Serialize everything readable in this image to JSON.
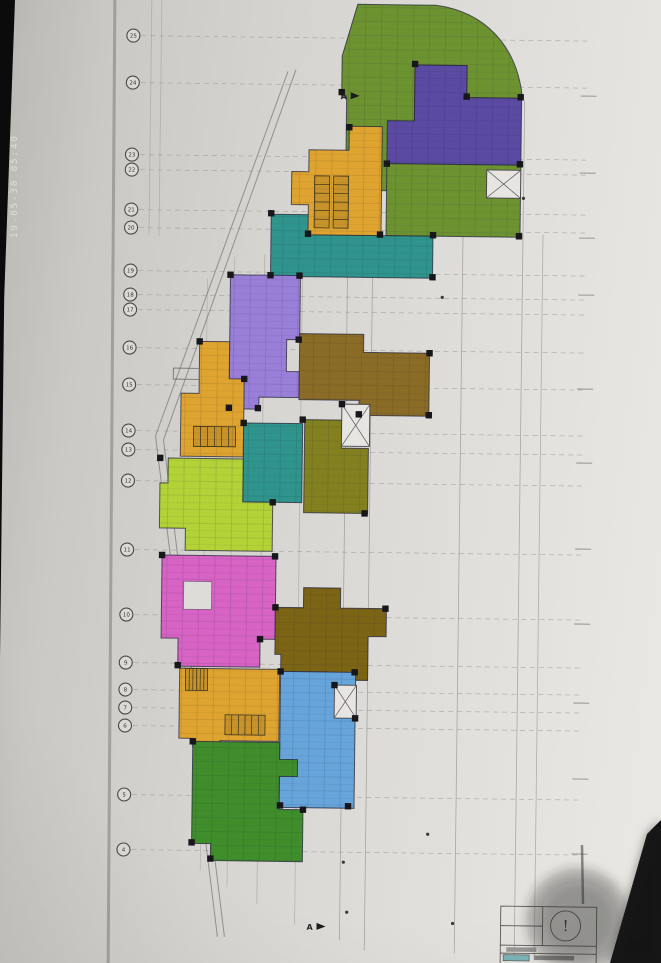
{
  "photo": {
    "timestamp": "19-05-30 05:40",
    "screen_edge_color": "#0b0b0b"
  },
  "plan": {
    "grid": {
      "circle_x": 128,
      "line_x1": 136,
      "line_x2": 584,
      "rows": [
        {
          "y": 38,
          "label": "25"
        },
        {
          "y": 85,
          "label": "24"
        },
        {
          "y": 157,
          "label": "23"
        },
        {
          "y": 172,
          "label": "22"
        },
        {
          "y": 212,
          "label": "21"
        },
        {
          "y": 230,
          "label": "20"
        },
        {
          "y": 273,
          "label": "19"
        },
        {
          "y": 297,
          "label": "18"
        },
        {
          "y": 312,
          "label": "17"
        },
        {
          "y": 350,
          "label": "16"
        },
        {
          "y": 387,
          "label": "15"
        },
        {
          "y": 433,
          "label": "14"
        },
        {
          "y": 452,
          "label": "13"
        },
        {
          "y": 483,
          "label": "12"
        },
        {
          "y": 552,
          "label": "11"
        },
        {
          "y": 617,
          "label": "10"
        },
        {
          "y": 665,
          "label": "9"
        },
        {
          "y": 692,
          "label": "8"
        },
        {
          "y": 710,
          "label": "7"
        },
        {
          "y": 728,
          "label": "6"
        },
        {
          "y": 797,
          "label": "5"
        },
        {
          "y": 852,
          "label": "4"
        }
      ],
      "verticals": [
        {
          "x": 146,
          "y1": 0,
          "y2": 238,
          "o": 0.3
        },
        {
          "x": 156,
          "y1": 0,
          "y2": 238,
          "o": 0.3
        },
        {
          "x": 205,
          "y1": 280,
          "y2": 872,
          "o": 0.3
        },
        {
          "x": 232,
          "y1": 258,
          "y2": 888,
          "o": 0.3
        },
        {
          "x": 262,
          "y1": 255,
          "y2": 905,
          "o": 0.35
        },
        {
          "x": 300,
          "y1": 235,
          "y2": 925,
          "o": 0.35
        },
        {
          "x": 345,
          "y1": 95,
          "y2": 940,
          "o": 0.5
        },
        {
          "x": 370,
          "y1": 60,
          "y2": 950,
          "o": 0.5
        },
        {
          "x": 460,
          "y1": 98,
          "y2": 952,
          "o": 0.5
        },
        {
          "x": 520,
          "y1": 98,
          "y2": 958,
          "o": 0.5
        },
        {
          "x": 540,
          "y1": 232,
          "y2": 958,
          "o": 0.45
        }
      ],
      "diagonals": [
        [
          283,
          72,
          155,
          438
        ],
        [
          291,
          70,
          163,
          442
        ],
        [
          155,
          438,
          223,
          938
        ],
        [
          163,
          442,
          230,
          938
        ]
      ],
      "right_ticks": [
        93,
        170,
        235,
        292,
        386,
        460,
        546,
        621,
        700,
        776,
        851
      ],
      "right_tick_x1": 576,
      "right_tick_x2": 592
    },
    "units": [
      {
        "id": "unit-green-top",
        "color": "#6d9331",
        "path": "M352,4 L430,4 C480,10 510,44 517,90 L517,96 L462,96 L462,64 L410,64 L410,190 L376,190 L376,162 L342,162 L342,96 L337,96 L337,56 Z"
      },
      {
        "id": "unit-purple",
        "color": "#5b4aa2",
        "path": "M410,64 L462,64 L462,96 L517,96 L517,163 L383,163 L383,120 L410,120 Z"
      },
      {
        "id": "unit-green-right",
        "color": "#6d9331",
        "path": "M383,163 L517,163 L517,235 L383,235 Z"
      },
      {
        "id": "unit-teal-top",
        "color": "#2f948c",
        "path": "M268,215 L310,215 L310,235 L430,235 L430,277 L268,277 Z"
      },
      {
        "id": "unit-orange-core-1",
        "color": "#dfa42f",
        "path": "M345,126 L378,126 L378,235 L305,235 L305,205 L288,205 L288,172 L305,172 L305,150 L345,150 Z"
      },
      {
        "id": "unit-violet",
        "color": "#9a7fd8",
        "path": "M228,276 L298,276 L298,340 L285,340 L285,372 L298,372 L298,398 L258,398 L258,410 L228,410 Z"
      },
      {
        "id": "unit-brown-mid",
        "color": "#8a6c26",
        "path": "M298,334 L362,334 L362,352 L428,352 L428,415 L358,415 L358,400 L298,400 Z"
      },
      {
        "id": "unit-orange-core-2",
        "color": "#dfa42f",
        "path": "M198,343 L228,343 L228,380 L243,380 L243,458 L180,458 L180,395 L198,395 Z"
      },
      {
        "id": "unit-olive",
        "color": "#83811f",
        "path": "M304,420 L341,420 L341,448 L368,448 L368,513 L304,513 Z"
      },
      {
        "id": "unit-teal-mid",
        "color": "#2f948c",
        "path": "M243,424 L302,424 L302,503 L243,503 Z"
      },
      {
        "id": "unit-lime",
        "color": "#b2d238",
        "path": "M168,460 L243,460 L243,503 L273,503 L273,552 L186,552 L186,530 L160,530 L160,485 L168,485 Z"
      },
      {
        "id": "unit-magenta",
        "color": "#d763c4",
        "path": "M163,557 L277,557 L277,640 L262,640 L262,668 L180,668 L180,640 L163,640 Z"
      },
      {
        "id": "unit-brown-dark",
        "color": "#7c6415",
        "path": "M277,608 L305,608 L305,588 L342,588 L342,608 L388,608 L388,636 L370,636 L370,680 L330,680 L330,672 L283,672 L283,655 L277,655 Z"
      },
      {
        "id": "unit-orange-core-3",
        "color": "#dfa42f",
        "path": "M182,670 L282,670 L282,742 L223,742 L223,748 L196,748 L196,740 L182,740 Z"
      },
      {
        "id": "unit-blue",
        "color": "#66a4da",
        "path": "M283,672 L358,672 L358,808 L283,808 Z"
      },
      {
        "id": "unit-green-bottom",
        "color": "#3f8e2b",
        "path": "M196,743 L283,743 L283,760 L301,760 L301,777 L283,777 L283,810 L307,810 L307,862 L215,862 L215,845 L196,845 Z"
      }
    ],
    "holes": [
      {
        "x": 185,
        "y": 583,
        "w": 28,
        "h": 28
      }
    ],
    "xboxes": [
      {
        "x": 483,
        "y": 168,
        "w": 34,
        "h": 28
      },
      {
        "x": 341,
        "y": 404,
        "w": 28,
        "h": 42
      },
      {
        "x": 337,
        "y": 685,
        "w": 22,
        "h": 33
      }
    ],
    "stairs": [
      {
        "x": 311,
        "y": 176,
        "w": 15,
        "h": 52,
        "dir": "v"
      },
      {
        "x": 330,
        "y": 176,
        "w": 15,
        "h": 52,
        "dir": "v"
      },
      {
        "x": 193,
        "y": 428,
        "w": 42,
        "h": 20,
        "dir": "h"
      },
      {
        "x": 188,
        "y": 670,
        "w": 22,
        "h": 22,
        "dir": "h"
      },
      {
        "x": 228,
        "y": 716,
        "w": 40,
        "h": 20,
        "dir": "h"
      }
    ],
    "columns": [
      [
        337,
        92
      ],
      [
        410,
        63
      ],
      [
        462,
        95
      ],
      [
        516,
        95
      ],
      [
        516,
        162
      ],
      [
        383,
        163
      ],
      [
        430,
        234
      ],
      [
        516,
        234
      ],
      [
        268,
        214
      ],
      [
        305,
        234
      ],
      [
        377,
        234
      ],
      [
        345,
        127
      ],
      [
        228,
        276
      ],
      [
        297,
        276
      ],
      [
        297,
        340
      ],
      [
        257,
        409
      ],
      [
        228,
        409
      ],
      [
        198,
        343
      ],
      [
        243,
        380
      ],
      [
        428,
        352
      ],
      [
        428,
        414
      ],
      [
        358,
        414
      ],
      [
        302,
        420
      ],
      [
        243,
        424
      ],
      [
        160,
        460
      ],
      [
        273,
        503
      ],
      [
        163,
        557
      ],
      [
        276,
        557
      ],
      [
        180,
        667
      ],
      [
        262,
        640
      ],
      [
        277,
        608
      ],
      [
        387,
        608
      ],
      [
        283,
        672
      ],
      [
        357,
        672
      ],
      [
        352,
        806
      ],
      [
        284,
        806
      ],
      [
        307,
        810
      ],
      [
        215,
        860
      ],
      [
        196,
        743
      ],
      [
        196,
        844
      ],
      [
        341,
        404
      ],
      [
        365,
        513
      ],
      [
        337,
        685
      ],
      [
        358,
        718
      ],
      [
        268,
        276
      ],
      [
        430,
        276
      ]
    ],
    "specks": [
      [
        440,
        296
      ],
      [
        520,
        196
      ],
      [
        432,
        833
      ],
      [
        352,
        912
      ],
      [
        458,
        922
      ],
      [
        348,
        862
      ]
    ],
    "markers": [
      {
        "x": 336,
        "y": 99,
        "label": "A"
      },
      {
        "x": 312,
        "y": 930,
        "label": "A"
      }
    ],
    "small_box": {
      "x": 172,
      "y": 370,
      "w": 26,
      "h": 11
    },
    "titleblock": {
      "x": 506,
      "y": 904,
      "w": 96,
      "h": 59,
      "divider_x": 548,
      "row_y1": 943,
      "row_y2": 951,
      "mark": "!",
      "accent": "#7ab5b8",
      "circle_cx": 571,
      "circle_cy": 923,
      "circle_r": 15
    },
    "artifacts": {
      "shadow": {
        "cx": 578,
        "cy": 920,
        "r": 52
      },
      "stick": {
        "x1": 582,
        "y1": 845,
        "x2": 583,
        "y2": 904
      },
      "black_wedge_path": "M661,820 L661,963 L610,963 L647,834 Z"
    }
  }
}
